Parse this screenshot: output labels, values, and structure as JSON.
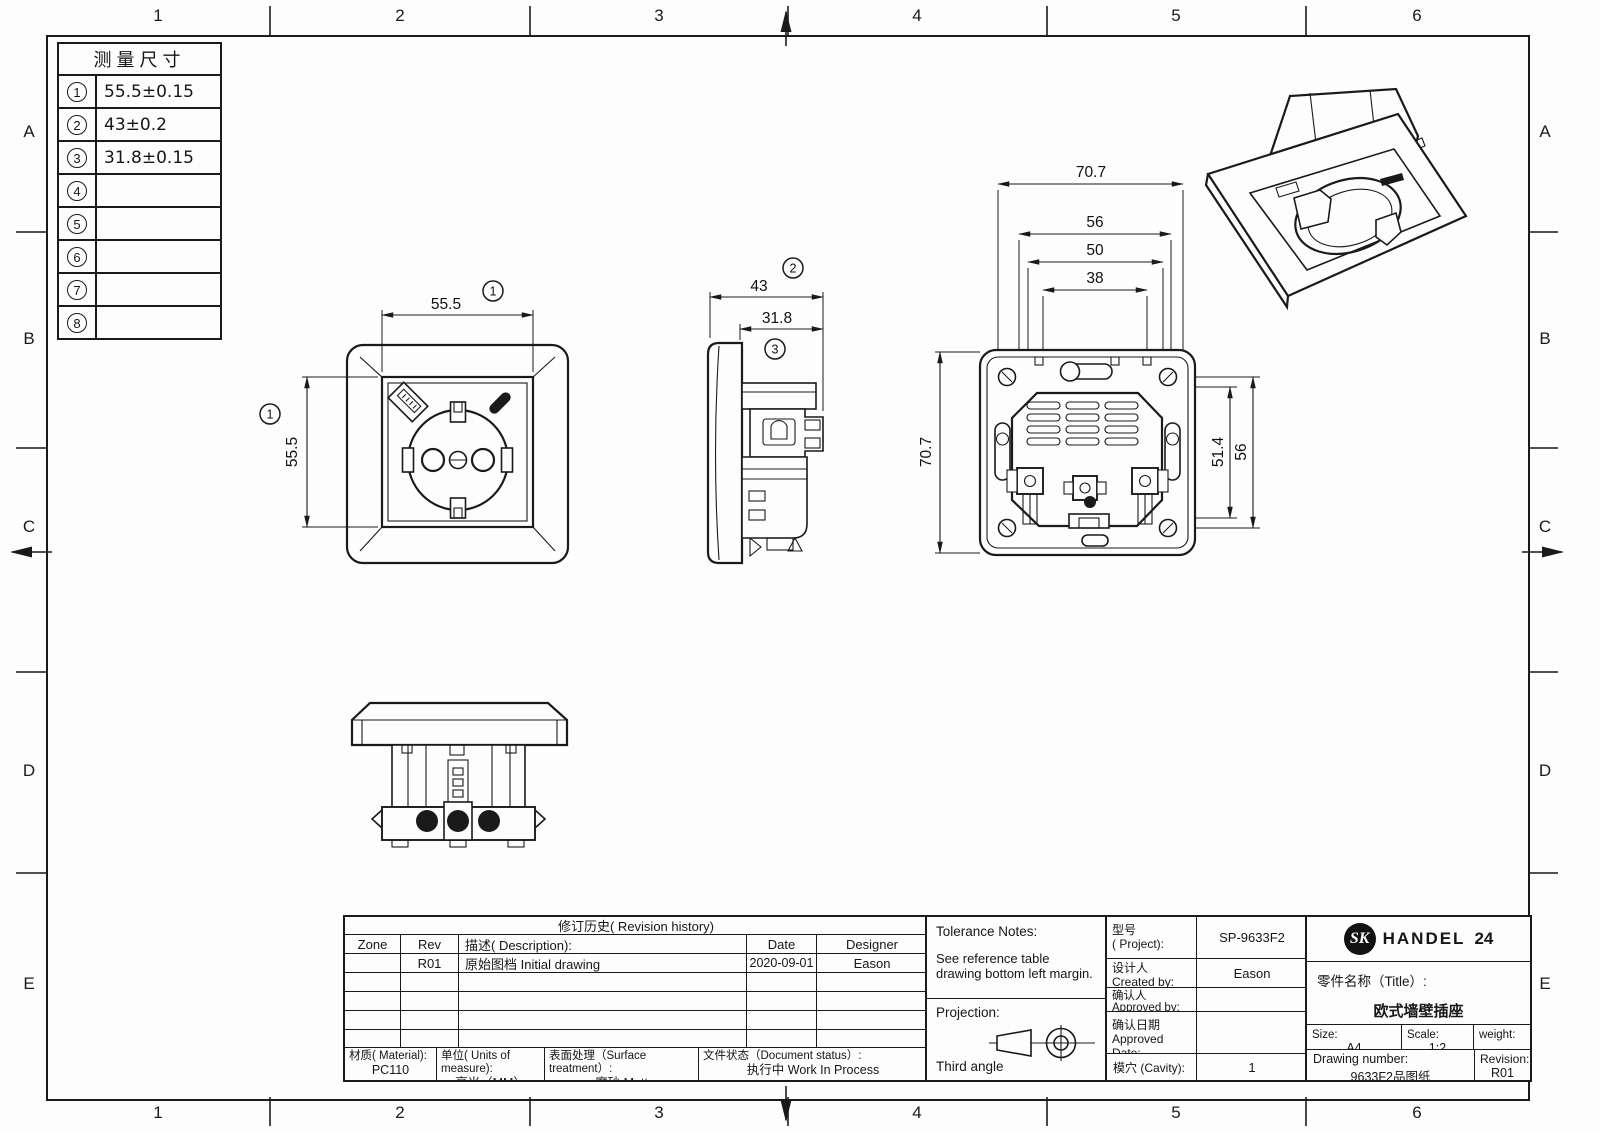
{
  "drawing": {
    "grid": {
      "columns": [
        "1",
        "2",
        "3",
        "4",
        "5",
        "6"
      ],
      "rows": [
        "A",
        "B",
        "C",
        "D",
        "E"
      ]
    },
    "measure_table": {
      "title": "测量尺寸",
      "rows": [
        {
          "ref": "1",
          "value": "55.5±0.15"
        },
        {
          "ref": "2",
          "value": "43±0.2"
        },
        {
          "ref": "3",
          "value": "31.8±0.15"
        },
        {
          "ref": "4",
          "value": ""
        },
        {
          "ref": "5",
          "value": ""
        },
        {
          "ref": "6",
          "value": ""
        },
        {
          "ref": "7",
          "value": ""
        },
        {
          "ref": "8",
          "value": ""
        }
      ]
    },
    "views": {
      "front": {
        "dim_width": "55.5",
        "dim_width_ref": "1",
        "dim_height": "55.5",
        "dim_height_ref": "1"
      },
      "side": {
        "dim_total": "43",
        "dim_total_ref": "2",
        "dim_body": "31.8",
        "dim_body_ref": "3"
      },
      "back": {
        "dim_w1": "70.7",
        "dim_w2": "56",
        "dim_w3": "50",
        "dim_w4": "38",
        "dim_left": "70.7",
        "dim_r1": "51.4",
        "dim_r2": "56"
      }
    },
    "revision": {
      "title": "修订历史( Revision history)",
      "col_zone": "Zone",
      "col_rev": "Rev",
      "col_desc": "描述( Description):",
      "col_date": "Date",
      "col_designer": "Designer",
      "rows": [
        {
          "zone": "",
          "rev": "R01",
          "desc": "原始图档 Initial drawing",
          "date": "2020-09-01",
          "designer": "Eason"
        }
      ]
    },
    "materials": {
      "material_label": "材质( Material):",
      "material_value": "PC110",
      "units_label": "单位( Units of measure):",
      "units_value": "毫米（MM）",
      "surface_label": "表面处理（Surface treatment）:",
      "surface_value": "磨砂 Matt",
      "status_label": "文件状态（Document status）:",
      "status_value": "执行中 Work In Process"
    },
    "info": {
      "tolerance_title": "Tolerance Notes:",
      "tolerance_line1": "See reference table",
      "tolerance_line2": "drawing bottom left margin.",
      "projection_label": "Projection:",
      "projection_value": "Third angle",
      "project_zh": "型号",
      "project_en": "( Project):",
      "project_value": "SP-9633F2",
      "created_zh": "设计人",
      "created_en": "Created by:",
      "created_value": "Eason",
      "approved_zh": "确认人",
      "approved_en": "Approved by:",
      "approved_value": "",
      "date_zh": "确认日期",
      "date_en": "Approved Date:",
      "date_value": "",
      "cavity_label": "模穴 (Cavity):",
      "cavity_value": "1"
    },
    "brand": {
      "monogram": "SK",
      "name": "HANDEL",
      "number": "24",
      "title_label": "零件名称（Title）:",
      "title_value": "欧式墙壁插座",
      "size_label": "Size:",
      "size_value": "A4",
      "scale_label": "Scale:",
      "scale_value": "1:2",
      "weight_label": "weight:",
      "weight_value": "",
      "dwg_label": "Drawing number:",
      "dwg_value": "9633F2品图纸",
      "rev_label": "Revision:",
      "rev_value": "R01"
    }
  }
}
